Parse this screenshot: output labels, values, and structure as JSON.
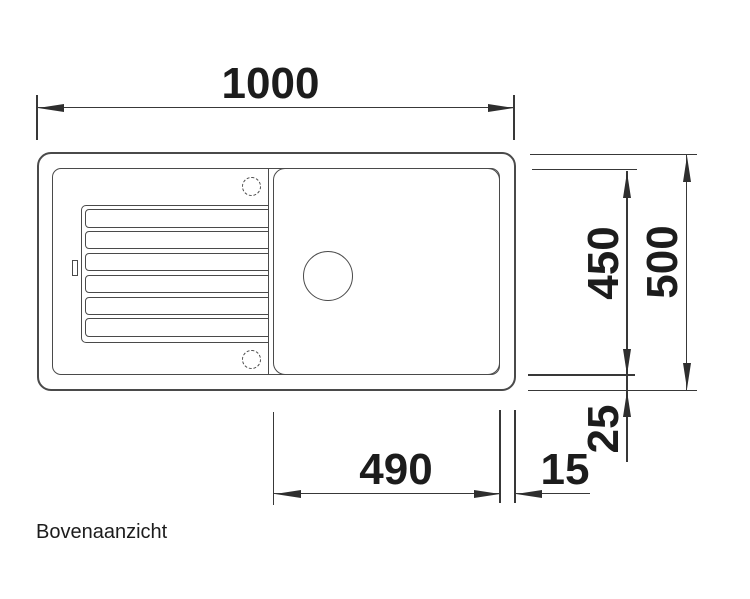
{
  "diagram": {
    "caption": "Bovenaanzicht",
    "dimension_labels": {
      "overall_width": "1000",
      "inner_depth": "450",
      "overall_depth": "500",
      "basin_width": "490",
      "right_rim": "15",
      "bottom_rim": "25"
    },
    "colors": {
      "background": "#ffffff",
      "drawing_line": "#4a4a4a",
      "dimension_line": "#383838",
      "text": "#1c1c1c"
    }
  }
}
